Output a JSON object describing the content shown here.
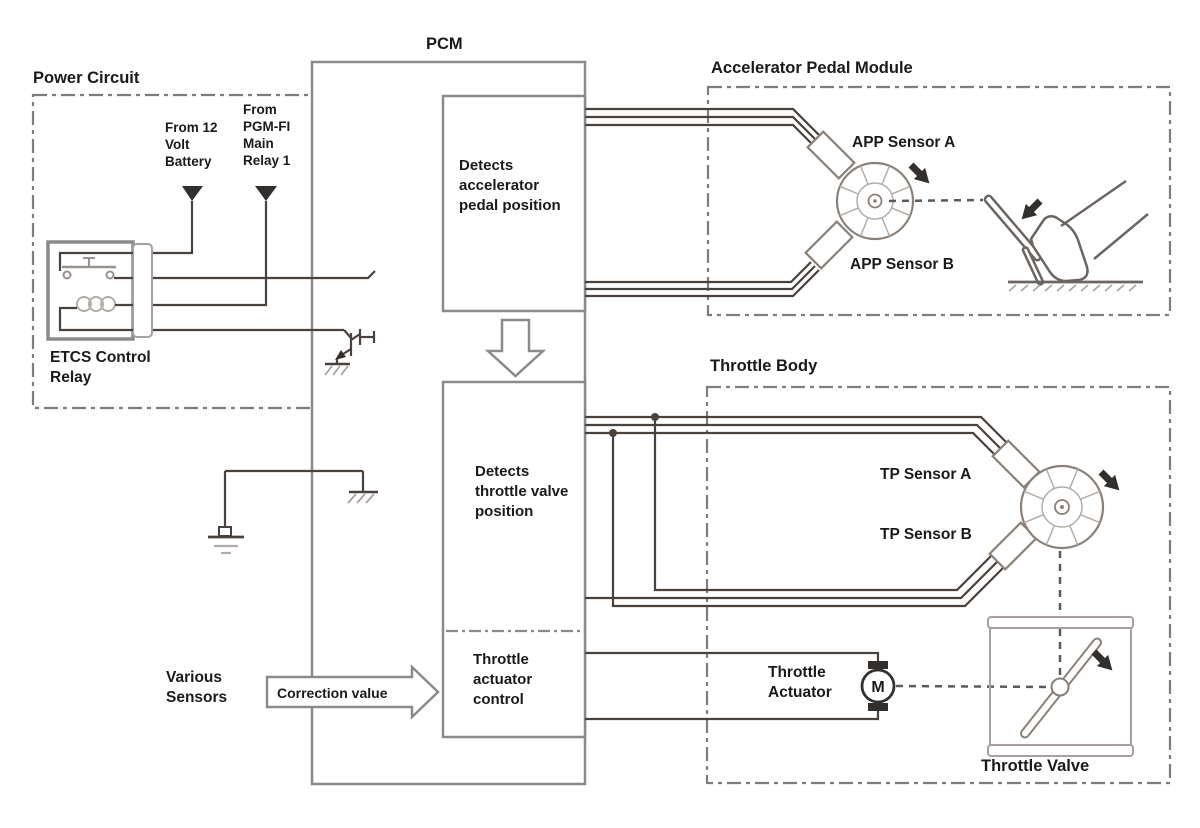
{
  "labels": {
    "power_circuit": "Power Circuit",
    "pcm": "PCM",
    "accelerator_pedal_module": "Accelerator Pedal Module",
    "throttle_body": "Throttle Body",
    "from_battery": "From 12 Volt Battery",
    "from_pgm_fi": "From PGM-FI Main Relay 1",
    "etcs_relay": "ETCS Control Relay",
    "detects_app": "Detects accelerator pedal position",
    "detects_tp": "Detects throttle valve position",
    "throttle_actuator_control": "Throttle actuator control",
    "various_sensors": "Various Sensors",
    "correction_value": "Correction value",
    "app_sensor_a": "APP Sensor A",
    "app_sensor_b": "APP Sensor B",
    "tp_sensor_a": "TP Sensor A",
    "tp_sensor_b": "TP Sensor B",
    "throttle_actuator": "Throttle Actuator",
    "throttle_valve": "Throttle Valve",
    "motor": "M"
  },
  "colors": {
    "background": "#ffffff",
    "wire": "#4a403c",
    "box_stroke": "#8a8a8a",
    "dashed_stroke": "#7d7d7d",
    "mechanical_stroke": "#6b6460",
    "arrow_fill": "#332f2d",
    "text": "#1a1a1a"
  }
}
